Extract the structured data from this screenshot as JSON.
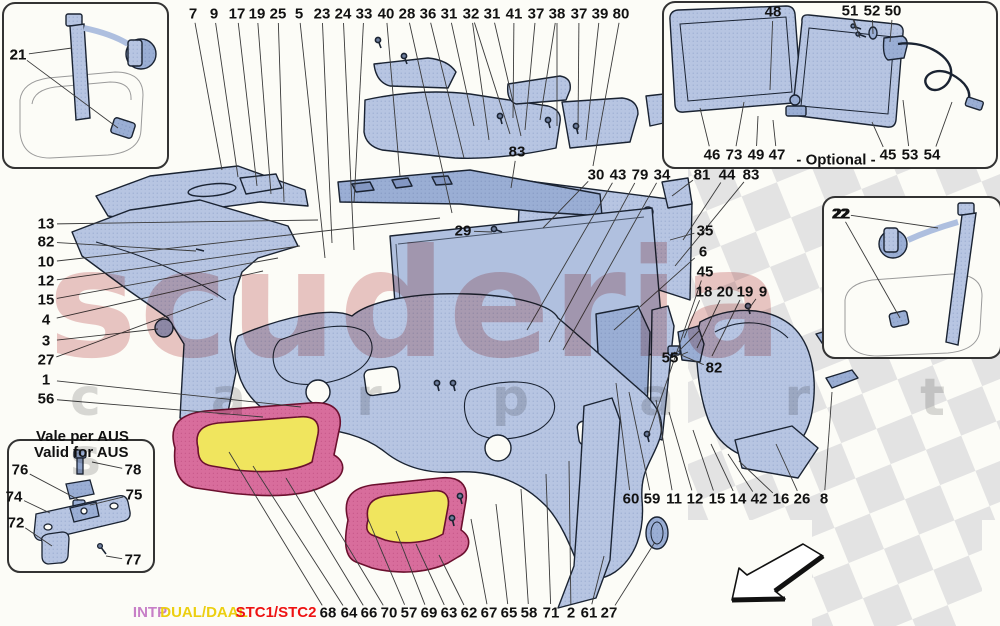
{
  "title": "Ferrari interior trim exploded parts diagram",
  "watermark": {
    "line1": "scuderia",
    "line2": "c a r  p a r t s"
  },
  "legend": {
    "items": [
      {
        "label": "INTP",
        "color": "#c77fc7",
        "x": 150
      },
      {
        "label": "DUAL/DAAL",
        "color": "#eccf10",
        "x": 204
      },
      {
        "label": "STC1/STC2",
        "color": "#ee1212",
        "x": 276
      }
    ]
  },
  "insets": {
    "belt_left": {
      "label": "21"
    },
    "belt_right": {
      "label": "22"
    },
    "optional": {
      "label": "- Optional -"
    },
    "aus": {
      "title_line1": "Vale per AUS",
      "title_line2": "Valid for AUS"
    }
  },
  "colors": {
    "background": "#fcfcf7",
    "part_fill": "#b7c5e2",
    "part_fill_dark": "#9aaed4",
    "part_stroke": "#1a2332",
    "seat_pink": "#d86d9c",
    "seat_yellow": "#f0e55e",
    "seat_stroke": "#6b102e",
    "checker_gray": "#e3e3e3",
    "leader_line": "#3a3a3a",
    "watermark_red": "#c05555",
    "watermark_gray": "#bbbbbb",
    "label_text": "#111111"
  },
  "callouts": [
    {
      "n": "7",
      "x": 193,
      "y": 14,
      "t": [
        [
          222,
          170
        ]
      ]
    },
    {
      "n": "9",
      "x": 214,
      "y": 14,
      "t": [
        [
          238,
          177
        ]
      ]
    },
    {
      "n": "17",
      "x": 237,
      "y": 14,
      "t": [
        [
          257,
          186
        ]
      ]
    },
    {
      "n": "19",
      "x": 257,
      "y": 14,
      "t": [
        [
          271,
          194
        ]
      ]
    },
    {
      "n": "25",
      "x": 278,
      "y": 14,
      "t": [
        [
          284,
          202
        ]
      ]
    },
    {
      "n": "5",
      "x": 299,
      "y": 14,
      "t": [
        [
          325,
          258
        ]
      ]
    },
    {
      "n": "23",
      "x": 322,
      "y": 14,
      "t": [
        [
          332,
          243
        ]
      ]
    },
    {
      "n": "24",
      "x": 343,
      "y": 14,
      "t": [
        [
          354,
          250
        ]
      ]
    },
    {
      "n": "33",
      "x": 364,
      "y": 14,
      "t": [
        [
          354,
          203
        ]
      ]
    },
    {
      "n": "40",
      "x": 386,
      "y": 14,
      "t": [
        [
          400,
          176
        ]
      ]
    },
    {
      "n": "28",
      "x": 407,
      "y": 14,
      "t": [
        [
          452,
          213
        ]
      ]
    },
    {
      "n": "36",
      "x": 428,
      "y": 14,
      "t": [
        [
          464,
          158
        ]
      ]
    },
    {
      "n": "31",
      "x": 449,
      "y": 14,
      "t": [
        [
          474,
          126
        ]
      ]
    },
    {
      "n": "32",
      "x": 471,
      "y": 14,
      "t": [
        [
          489,
          140
        ],
        [
          510,
          134
        ]
      ]
    },
    {
      "n": "31",
      "x": 492,
      "y": 14,
      "t": [
        [
          521,
          136
        ]
      ]
    },
    {
      "n": "41",
      "x": 514,
      "y": 14,
      "t": [
        [
          513,
          118
        ]
      ]
    },
    {
      "n": "37",
      "x": 536,
      "y": 14,
      "t": [
        [
          525,
          130
        ]
      ]
    },
    {
      "n": "38",
      "x": 557,
      "y": 14,
      "t": [
        [
          540,
          120
        ],
        [
          557,
          126
        ]
      ]
    },
    {
      "n": "37",
      "x": 579,
      "y": 14,
      "t": [
        [
          578,
          130
        ]
      ]
    },
    {
      "n": "39",
      "x": 600,
      "y": 14,
      "t": [
        [
          586,
          140
        ]
      ]
    },
    {
      "n": "80",
      "x": 621,
      "y": 14,
      "t": [
        [
          593,
          166
        ]
      ]
    },
    {
      "n": "13",
      "x": 46,
      "y": 224,
      "t": [
        [
          318,
          220
        ]
      ]
    },
    {
      "n": "82",
      "x": 46,
      "y": 242,
      "t": [
        [
          196,
          251
        ]
      ]
    },
    {
      "n": "10",
      "x": 46,
      "y": 262,
      "t": [
        [
          440,
          218
        ]
      ]
    },
    {
      "n": "12",
      "x": 46,
      "y": 281,
      "t": [
        [
          300,
          246
        ]
      ]
    },
    {
      "n": "15",
      "x": 46,
      "y": 300,
      "t": [
        [
          278,
          258
        ]
      ]
    },
    {
      "n": "4",
      "x": 46,
      "y": 320,
      "t": [
        [
          263,
          271
        ]
      ]
    },
    {
      "n": "3",
      "x": 46,
      "y": 341,
      "t": [
        [
          158,
          329
        ]
      ]
    },
    {
      "n": "27",
      "x": 46,
      "y": 360,
      "t": [
        [
          213,
          299
        ]
      ]
    },
    {
      "n": "1",
      "x": 46,
      "y": 380,
      "t": [
        [
          301,
          407
        ]
      ]
    },
    {
      "n": "56",
      "x": 46,
      "y": 399,
      "t": [
        [
          263,
          417
        ]
      ]
    },
    {
      "n": "29",
      "x": 463,
      "y": 231,
      "t": [
        [
          492,
          232
        ]
      ]
    },
    {
      "n": "83",
      "x": 517,
      "y": 152,
      "t": [
        [
          511,
          188
        ]
      ]
    },
    {
      "n": "30",
      "x": 596,
      "y": 175,
      "t": [
        [
          543,
          228
        ]
      ]
    },
    {
      "n": "43",
      "x": 618,
      "y": 175,
      "t": [
        [
          527,
          330
        ]
      ]
    },
    {
      "n": "79",
      "x": 640,
      "y": 175,
      "t": [
        [
          549,
          342
        ]
      ]
    },
    {
      "n": "34",
      "x": 662,
      "y": 175,
      "t": [
        [
          563,
          350
        ]
      ]
    },
    {
      "n": "81",
      "x": 702,
      "y": 175,
      "t": [
        [
          672,
          196
        ]
      ]
    },
    {
      "n": "44",
      "x": 727,
      "y": 175,
      "t": [
        [
          683,
          240
        ]
      ]
    },
    {
      "n": "83",
      "x": 751,
      "y": 175,
      "t": [
        [
          675,
          266
        ]
      ]
    },
    {
      "n": "35",
      "x": 705,
      "y": 231,
      "t": [
        [
          670,
          240
        ]
      ]
    },
    {
      "n": "6",
      "x": 703,
      "y": 252,
      "t": [
        [
          614,
          330
        ]
      ]
    },
    {
      "n": "45",
      "x": 705,
      "y": 272,
      "t": [
        [
          648,
          436
        ]
      ]
    },
    {
      "n": "18",
      "x": 704,
      "y": 292,
      "t": [
        [
          684,
          338
        ]
      ]
    },
    {
      "n": "20",
      "x": 725,
      "y": 292,
      "t": [
        [
          697,
          348
        ]
      ]
    },
    {
      "n": "19",
      "x": 745,
      "y": 292,
      "t": [
        [
          712,
          356
        ]
      ]
    },
    {
      "n": "9",
      "x": 763,
      "y": 292,
      "t": [
        [
          748,
          310
        ]
      ]
    },
    {
      "n": "55",
      "x": 670,
      "y": 358,
      "t": [
        [
          700,
          330
        ],
        [
          688,
          352
        ]
      ]
    },
    {
      "n": "82",
      "x": 714,
      "y": 368,
      "t": [
        [
          674,
          352
        ]
      ]
    },
    {
      "n": "60",
      "x": 631,
      "y": 499,
      "t": [
        [
          616,
          383
        ]
      ]
    },
    {
      "n": "59",
      "x": 652,
      "y": 499,
      "t": [
        [
          629,
          392
        ]
      ]
    },
    {
      "n": "11",
      "x": 674,
      "y": 499,
      "t": [
        [
          656,
          400
        ]
      ]
    },
    {
      "n": "12",
      "x": 695,
      "y": 499,
      "t": [
        [
          669,
          412
        ]
      ]
    },
    {
      "n": "15",
      "x": 717,
      "y": 499,
      "t": [
        [
          693,
          430
        ]
      ]
    },
    {
      "n": "14",
      "x": 738,
      "y": 499,
      "t": [
        [
          711,
          444
        ]
      ]
    },
    {
      "n": "42",
      "x": 759,
      "y": 499,
      "t": [
        [
          728,
          454
        ]
      ]
    },
    {
      "n": "16",
      "x": 781,
      "y": 499,
      "t": [
        [
          739,
          461
        ]
      ]
    },
    {
      "n": "26",
      "x": 802,
      "y": 499,
      "t": [
        [
          776,
          444
        ]
      ]
    },
    {
      "n": "8",
      "x": 824,
      "y": 499,
      "t": [
        [
          832,
          392
        ]
      ]
    },
    {
      "n": "68",
      "x": 328,
      "y": 613,
      "t": [
        [
          229,
          452
        ]
      ]
    },
    {
      "n": "64",
      "x": 349,
      "y": 613,
      "t": [
        [
          253,
          466
        ]
      ]
    },
    {
      "n": "66",
      "x": 369,
      "y": 613,
      "t": [
        [
          286,
          478
        ]
      ]
    },
    {
      "n": "70",
      "x": 389,
      "y": 613,
      "t": [
        [
          313,
          489
        ]
      ]
    },
    {
      "n": "57",
      "x": 409,
      "y": 613,
      "t": [
        [
          368,
          519
        ]
      ]
    },
    {
      "n": "69",
      "x": 429,
      "y": 613,
      "t": [
        [
          396,
          531
        ]
      ]
    },
    {
      "n": "63",
      "x": 449,
      "y": 613,
      "t": [
        [
          416,
          544
        ]
      ]
    },
    {
      "n": "62",
      "x": 469,
      "y": 613,
      "t": [
        [
          439,
          555
        ]
      ]
    },
    {
      "n": "67",
      "x": 489,
      "y": 613,
      "t": [
        [
          471,
          519
        ]
      ]
    },
    {
      "n": "65",
      "x": 509,
      "y": 613,
      "t": [
        [
          496,
          504
        ]
      ]
    },
    {
      "n": "58",
      "x": 529,
      "y": 613,
      "t": [
        [
          521,
          489
        ]
      ]
    },
    {
      "n": "71",
      "x": 551,
      "y": 613,
      "t": [
        [
          546,
          474
        ]
      ]
    },
    {
      "n": "2",
      "x": 571,
      "y": 613,
      "t": [
        [
          569,
          461
        ]
      ]
    },
    {
      "n": "61",
      "x": 589,
      "y": 613,
      "t": [
        [
          604,
          556
        ]
      ]
    },
    {
      "n": "27",
      "x": 609,
      "y": 613,
      "t": [
        [
          655,
          542
        ]
      ]
    },
    {
      "n": "21",
      "x": 18,
      "y": 55,
      "t": [
        [
          72,
          48
        ],
        [
          118,
          128
        ]
      ]
    },
    {
      "n": "22",
      "x": 840,
      "y": 214,
      "t": [
        [
          938,
          228
        ],
        [
          900,
          318
        ]
      ]
    },
    {
      "n": "48",
      "x": 773,
      "y": 12,
      "t": [
        [
          770,
          90
        ]
      ]
    },
    {
      "n": "51",
      "x": 850,
      "y": 11,
      "t": [
        [
          856,
          30
        ],
        [
          860,
          38
        ]
      ]
    },
    {
      "n": "52",
      "x": 872,
      "y": 11,
      "t": [
        [
          873,
          34
        ]
      ]
    },
    {
      "n": "50",
      "x": 893,
      "y": 11,
      "t": [
        [
          890,
          42
        ]
      ]
    },
    {
      "n": "46",
      "x": 712,
      "y": 155,
      "t": [
        [
          700,
          108
        ]
      ]
    },
    {
      "n": "73",
      "x": 734,
      "y": 155,
      "t": [
        [
          744,
          102
        ]
      ]
    },
    {
      "n": "49",
      "x": 756,
      "y": 155,
      "t": [
        [
          758,
          116
        ]
      ]
    },
    {
      "n": "47",
      "x": 777,
      "y": 155,
      "t": [
        [
          773,
          120
        ]
      ]
    },
    {
      "n": "45",
      "x": 888,
      "y": 155,
      "t": [
        [
          872,
          122
        ]
      ]
    },
    {
      "n": "53",
      "x": 910,
      "y": 155,
      "t": [
        [
          903,
          100
        ]
      ]
    },
    {
      "n": "54",
      "x": 932,
      "y": 155,
      "t": [
        [
          952,
          102
        ]
      ]
    },
    {
      "n": "76",
      "x": 20,
      "y": 470,
      "t": [
        [
          79,
          500
        ]
      ]
    },
    {
      "n": "78",
      "x": 133,
      "y": 470,
      "t": [
        [
          92,
          462
        ]
      ]
    },
    {
      "n": "74",
      "x": 14,
      "y": 497,
      "t": [
        [
          50,
          513
        ]
      ]
    },
    {
      "n": "75",
      "x": 134,
      "y": 495,
      "t": [
        [
          90,
          505
        ]
      ]
    },
    {
      "n": "72",
      "x": 16,
      "y": 523,
      "t": [
        [
          52,
          546
        ]
      ]
    },
    {
      "n": "77",
      "x": 133,
      "y": 560,
      "t": [
        [
          106,
          556
        ]
      ]
    }
  ]
}
